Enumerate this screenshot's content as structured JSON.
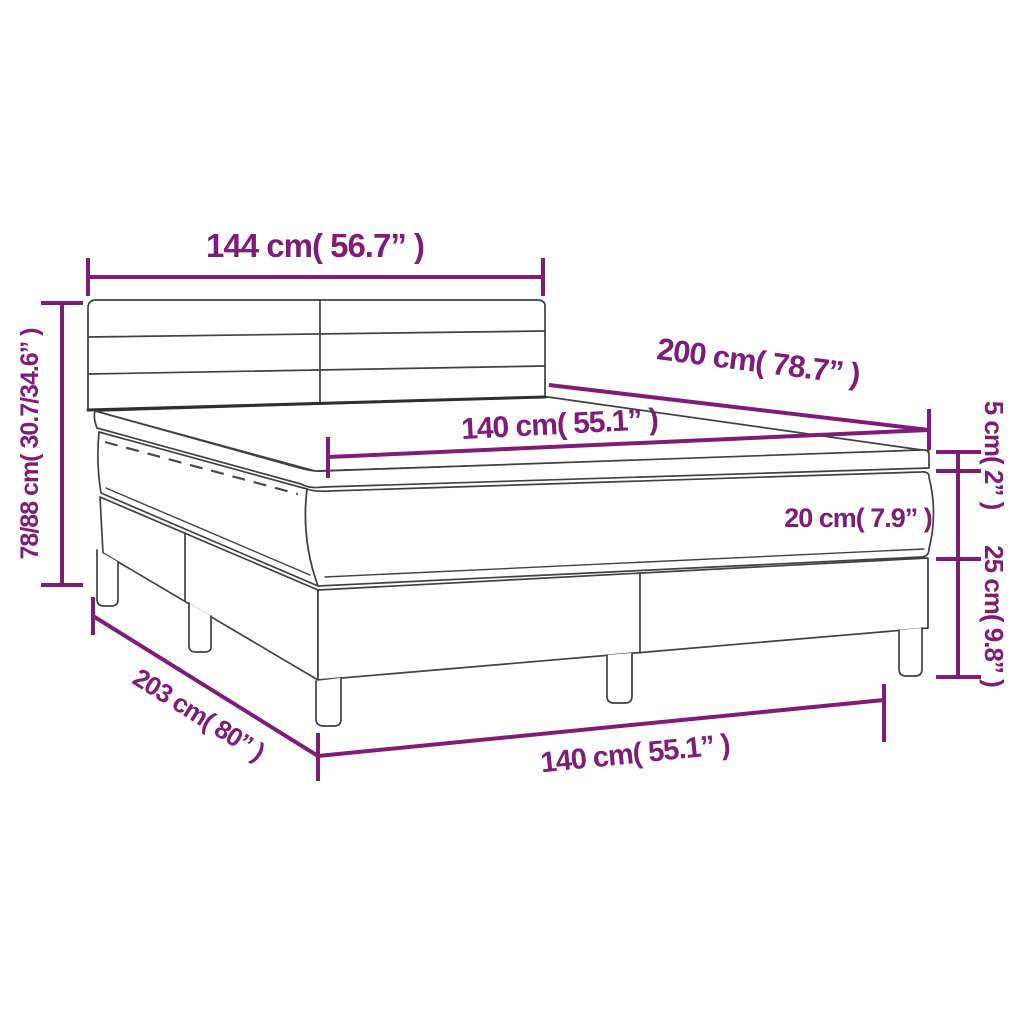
{
  "page": {
    "background": "#ffffff",
    "accent_color": "#801C78",
    "outline_color": "#414141",
    "figure": "box-spring-bed-line-drawing"
  },
  "labels": {
    "headboard_width": "144 cm( 56.7” )",
    "overall_height": "78/88 cm( 30.7/34.6” )",
    "bed_length": "200 cm( 78.7” )",
    "mattress_width": "140 cm( 55.1” )",
    "topper_height": "5 cm( 2” )",
    "mattress_height": "20 cm( 7.9” )",
    "base_height": "25 cm( 9.8” )",
    "base_length": "203 cm( 80” )",
    "mattress_width_bottom": "140 cm( 55.1” )"
  }
}
